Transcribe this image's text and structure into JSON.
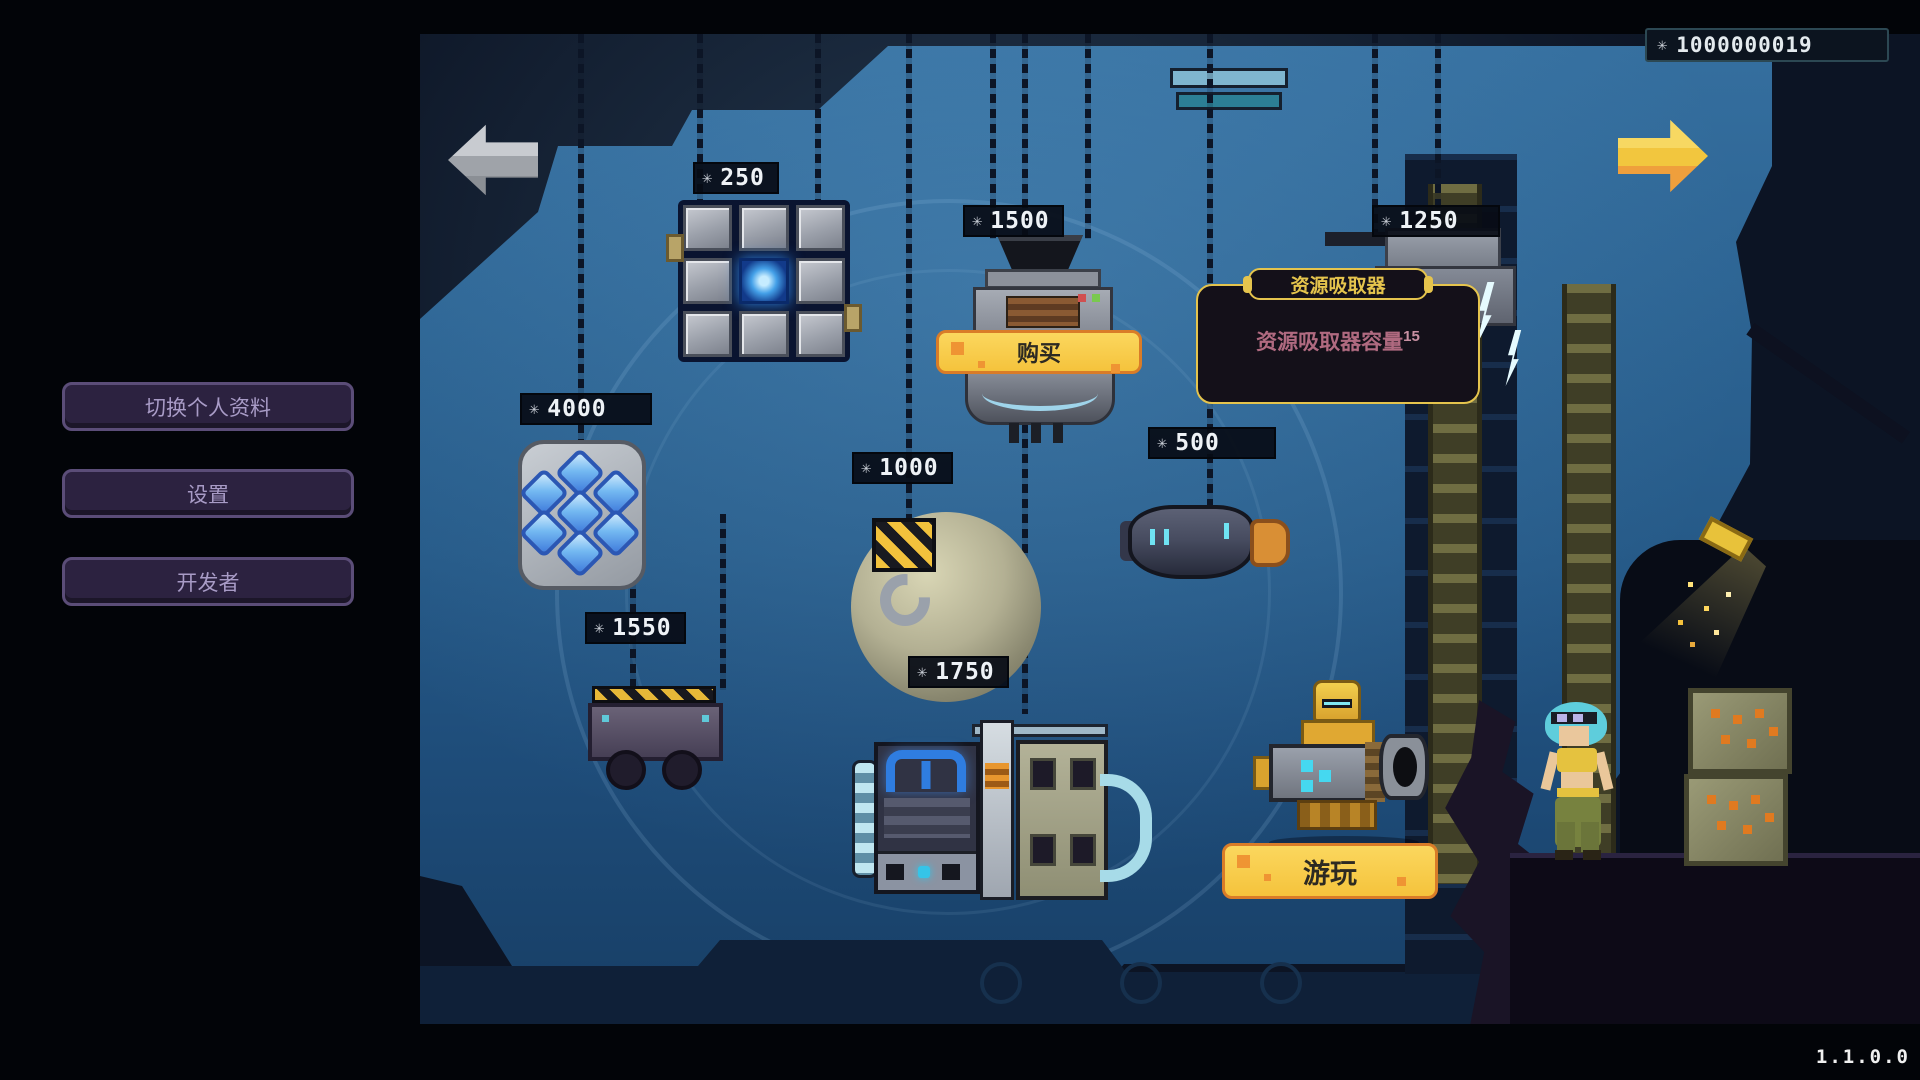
{
  "hud": {
    "currency": {
      "value": "1000000019"
    },
    "version": "1.1.0.0"
  },
  "icons": {
    "sparkle": "✳"
  },
  "menu": {
    "profile_label": "切换个人资料",
    "settings_label": "设置",
    "developer_label": "开发者"
  },
  "nav": {
    "prev_enabled": false,
    "next_enabled": true
  },
  "shop": {
    "buy_label": "购买",
    "play_label": "游玩",
    "tooltip": {
      "title": "资源吸取器",
      "stat_label": "资源吸取器容量",
      "stat_value": "15"
    },
    "items": [
      {
        "name": "circuit-core-block",
        "price": "250"
      },
      {
        "name": "resource-absorber",
        "price": "1500"
      },
      {
        "name": "right-machine",
        "price": "1250"
      },
      {
        "name": "crystal-cluster",
        "price": "4000"
      },
      {
        "name": "crane-hook",
        "price": "1000"
      },
      {
        "name": "thruster-pod",
        "price": "500"
      },
      {
        "name": "claw-machine",
        "price": "1550"
      },
      {
        "name": "generator",
        "price": "1750"
      }
    ]
  },
  "colors": {
    "accent_yellow": "#f5c33c",
    "accent_orange": "#d97c28",
    "tooltip_border": "#e5c44d",
    "menu_purple": "#2c2240",
    "scene_blue": "#2c6392"
  }
}
